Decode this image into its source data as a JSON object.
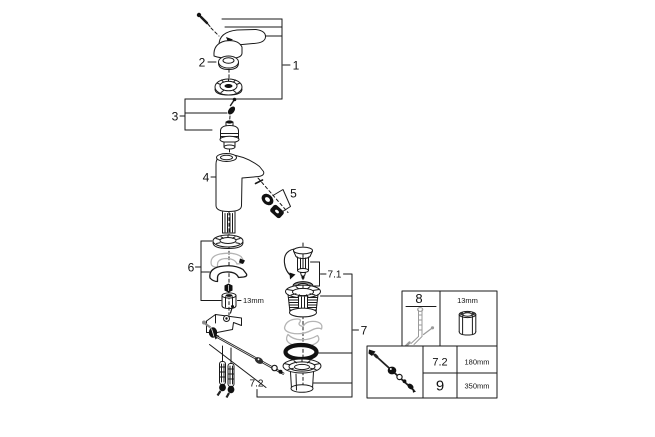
{
  "figure": {
    "background": "#ffffff",
    "line_color": "#1a1a1a",
    "muted_color": "#b4b4b4",
    "callouts": {
      "c1": "1",
      "c2": "2",
      "c3": "3",
      "c4": "4",
      "c5": "5",
      "c6": "6",
      "c7": "7",
      "c71": "7.1",
      "c72": "7.2",
      "nut_size": "13mm"
    },
    "legend": {
      "tool_ref": "8",
      "socket_size": "13mm",
      "rows": [
        {
          "ref": "7.2",
          "length": "180mm"
        },
        {
          "ref": "9",
          "length": "350mm"
        }
      ]
    }
  }
}
